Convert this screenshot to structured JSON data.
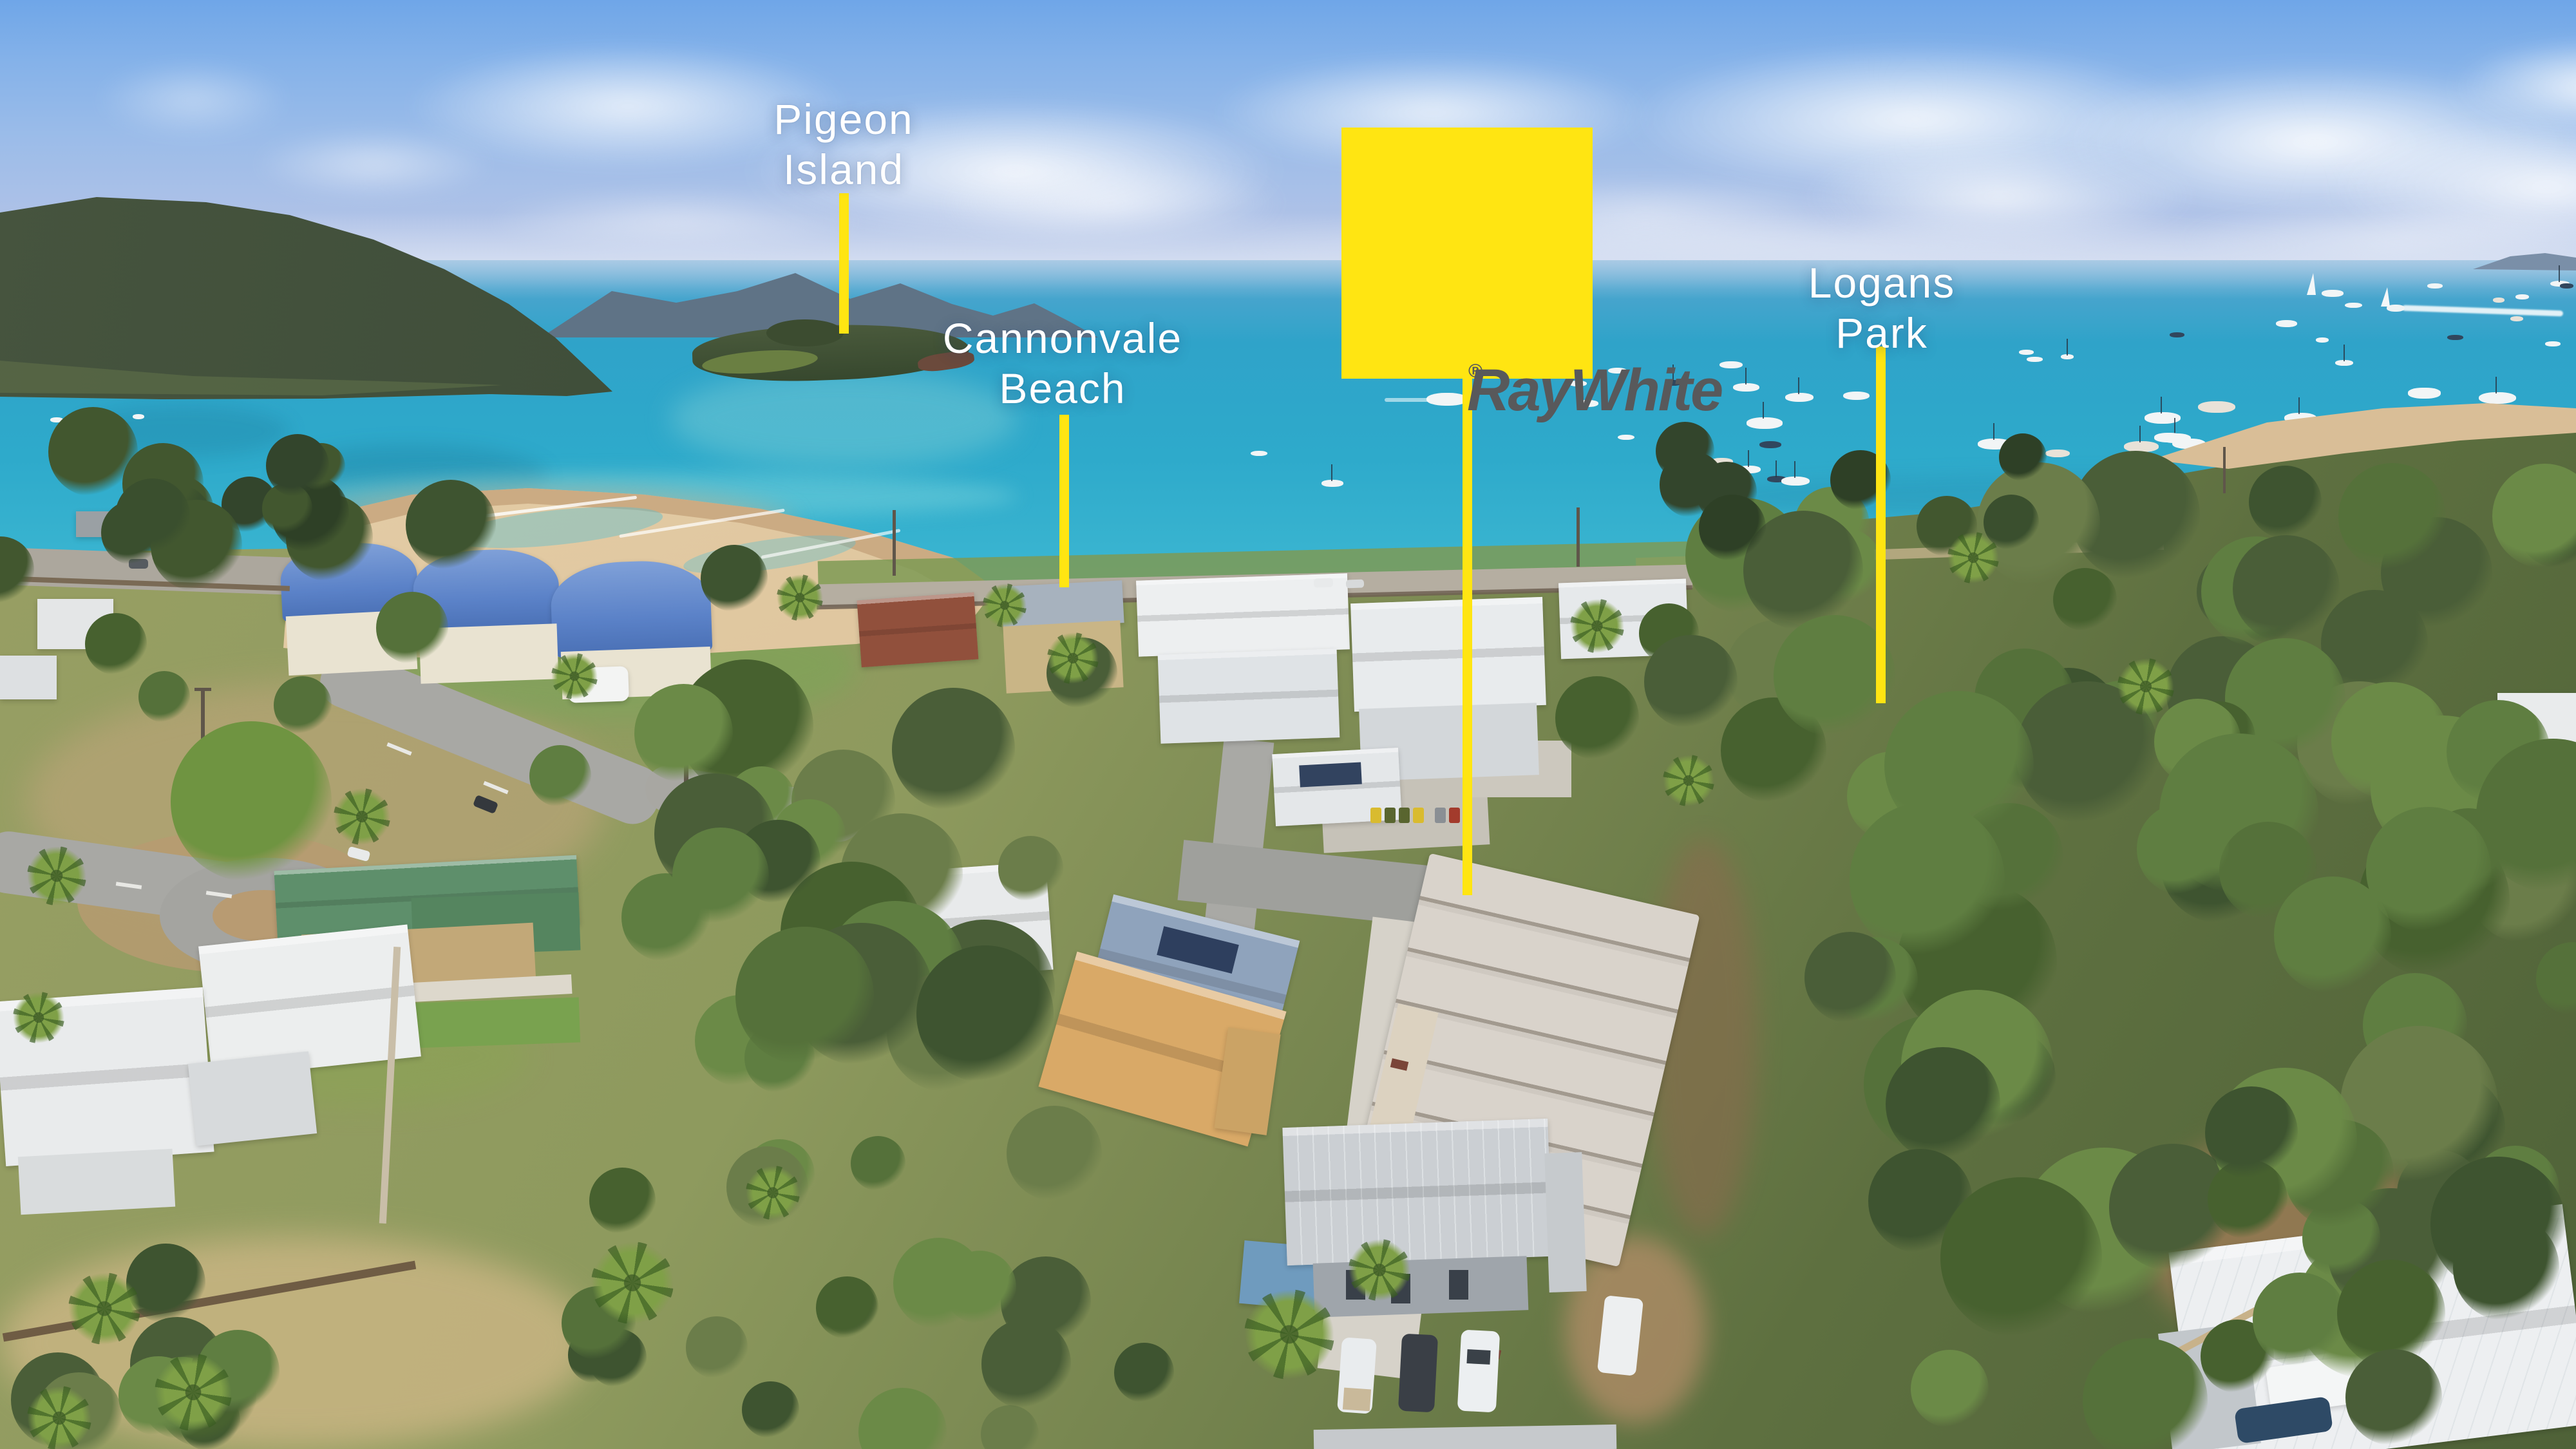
{
  "scene": {
    "description": "Aerial drone photo of a beachfront suburb (Cannonvale) with bay, moored yachts and tree reserve; real-estate marketing overlay",
    "location_labels": [
      {
        "id": "pigeon-island",
        "line1": "Pigeon",
        "line2": "Island"
      },
      {
        "id": "cannonvale-beach",
        "line1": "Cannonvale",
        "line2": "Beach"
      },
      {
        "id": "logans-park",
        "line1": "Logans",
        "line2": "Park"
      }
    ],
    "brand": {
      "logo_text": "RayWhite",
      "registered_mark": "®"
    },
    "colors": {
      "marker_yellow": "#FFE512",
      "logo_text_gray": "#58595B",
      "label_white": "#FFFFFF"
    }
  }
}
